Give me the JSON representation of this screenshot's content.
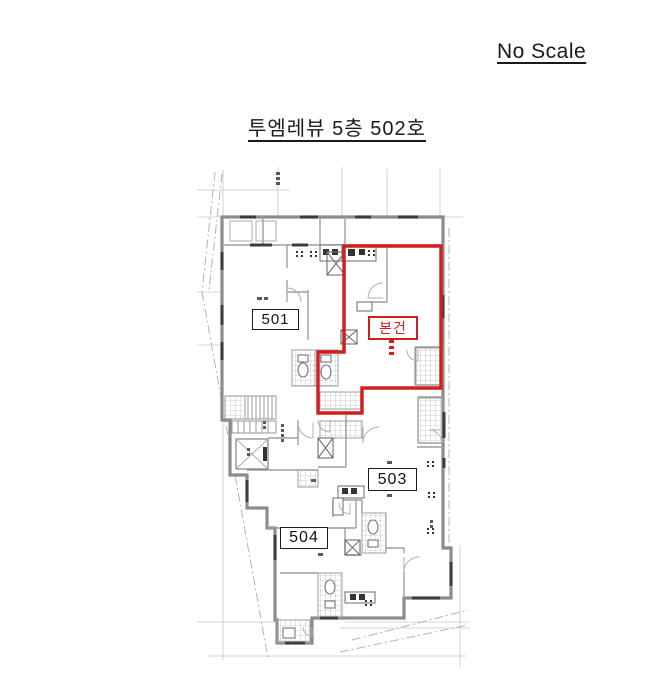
{
  "scale_note": "No Scale",
  "title": "투엠레뷰 5층 502호",
  "plan": {
    "subject_label": "본건",
    "unit_labels": {
      "u501": "501",
      "u503": "503",
      "u504": "504"
    },
    "colors": {
      "subject_red": "#d11e1e",
      "wall_gray": "#8c8c8c",
      "grid_gray": "#c6c6c6"
    }
  }
}
